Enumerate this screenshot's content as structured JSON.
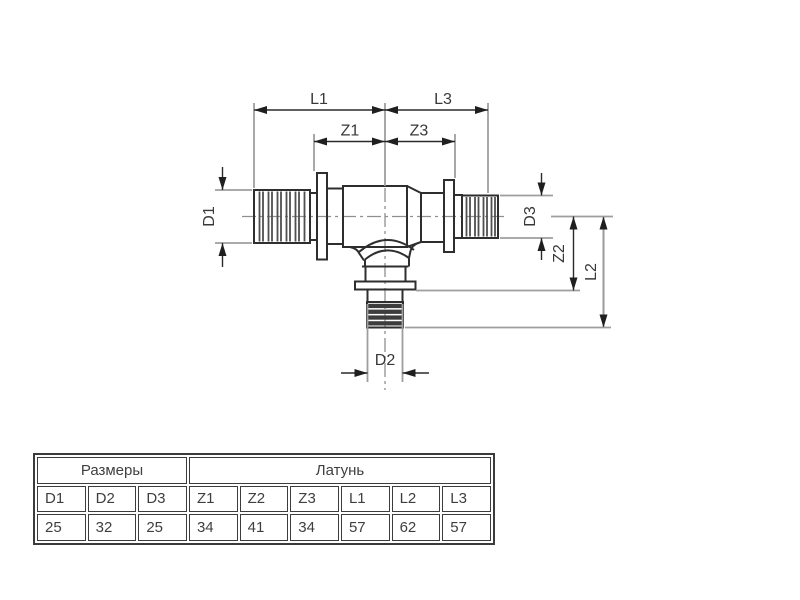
{
  "drawing": {
    "labels": {
      "L1": "L1",
      "L3": "L3",
      "Z1": "Z1",
      "Z3": "Z3",
      "D1": "D1",
      "D2": "D2",
      "D3": "D3",
      "Z2": "Z2",
      "L2": "L2"
    },
    "colors": {
      "outline": "#2e2e2e",
      "extension_line": "#9e9e9e",
      "dimension_line": "#2a2a2a",
      "label_text": "#383838"
    }
  },
  "table": {
    "group_headers": [
      {
        "label": "Размеры",
        "colspan": 3
      },
      {
        "label": "Латунь",
        "colspan": 6
      }
    ],
    "col_headers": [
      "D1",
      "D2",
      "D3",
      "Z1",
      "Z2",
      "Z3",
      "L1",
      "L2",
      "L3"
    ],
    "values": [
      "25",
      "32",
      "25",
      "34",
      "41",
      "34",
      "57",
      "62",
      "57"
    ],
    "border_color": "#3c3c3c",
    "text_color": "#3f3f3f"
  }
}
